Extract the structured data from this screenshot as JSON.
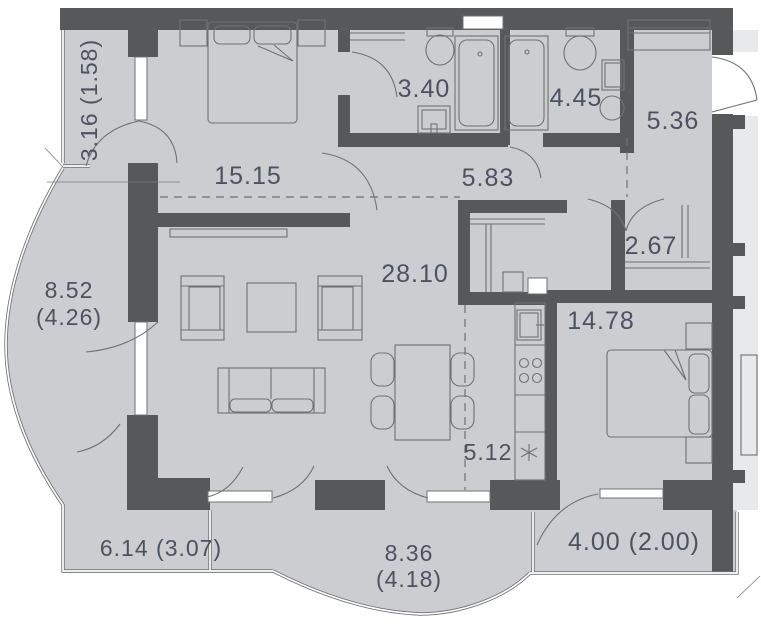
{
  "plan": {
    "rooms": {
      "balcony_top_left": {
        "area": "3.16 (1.58)"
      },
      "bedroom_1": {
        "area": "15.15"
      },
      "bathroom_1": {
        "area": "3.40"
      },
      "bathroom_2": {
        "area": "4.45"
      },
      "hallway": {
        "area": "5.36"
      },
      "corridor": {
        "area": "5.83"
      },
      "wardrobe": {
        "area": "2.67"
      },
      "balcony_left": {
        "area": "8.52",
        "area_reduced": "(4.26)"
      },
      "living_room": {
        "area": "28.10"
      },
      "bedroom_2": {
        "area": "14.78"
      },
      "kitchen": {
        "area": "5.12"
      },
      "balcony_bottom_left": {
        "area": "6.14 (3.07)"
      },
      "balcony_bottom_mid": {
        "area": "8.36",
        "area_reduced": "(4.18)"
      },
      "balcony_bottom_right": {
        "area": "4.00 (2.00)"
      }
    },
    "markers": {
      "utility": "*"
    },
    "colors": {
      "wall": "#56585a",
      "floor": "#cbcdd0",
      "label": "#4b5260",
      "outside": "#ffffff"
    }
  }
}
